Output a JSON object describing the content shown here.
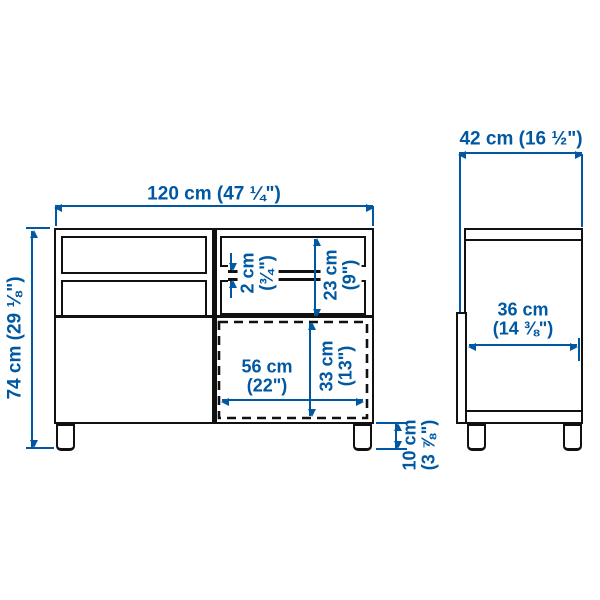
{
  "diagram_title": "Furniture dimension diagram (front and side views)",
  "colors": {
    "dimension_blue": "#0058a3",
    "outline_black": "#111111",
    "background": "#ffffff"
  },
  "dimensions": {
    "front_width": {
      "text": "120 cm (47 ¼\")"
    },
    "front_height": {
      "text": "74 cm (29 ⅛\")"
    },
    "shelf_thickness": {
      "line1": "2 cm",
      "line2": "(¾\")"
    },
    "top_compartment_height": {
      "line1": "23 cm",
      "line2": "(9\")"
    },
    "bottom_compartment_width": {
      "line1": "56 cm",
      "line2": "(22\")"
    },
    "bottom_compartment_height": {
      "line1": "33 cm",
      "line2": "(13\")"
    },
    "leg_height": {
      "line1": "10 cm",
      "line2": "(3 ⅞\")"
    },
    "side_depth": {
      "text": "42 cm (16 ½\")"
    },
    "side_inner_depth": {
      "line1": "36 cm",
      "line2": "(14 ⅜\")"
    }
  }
}
